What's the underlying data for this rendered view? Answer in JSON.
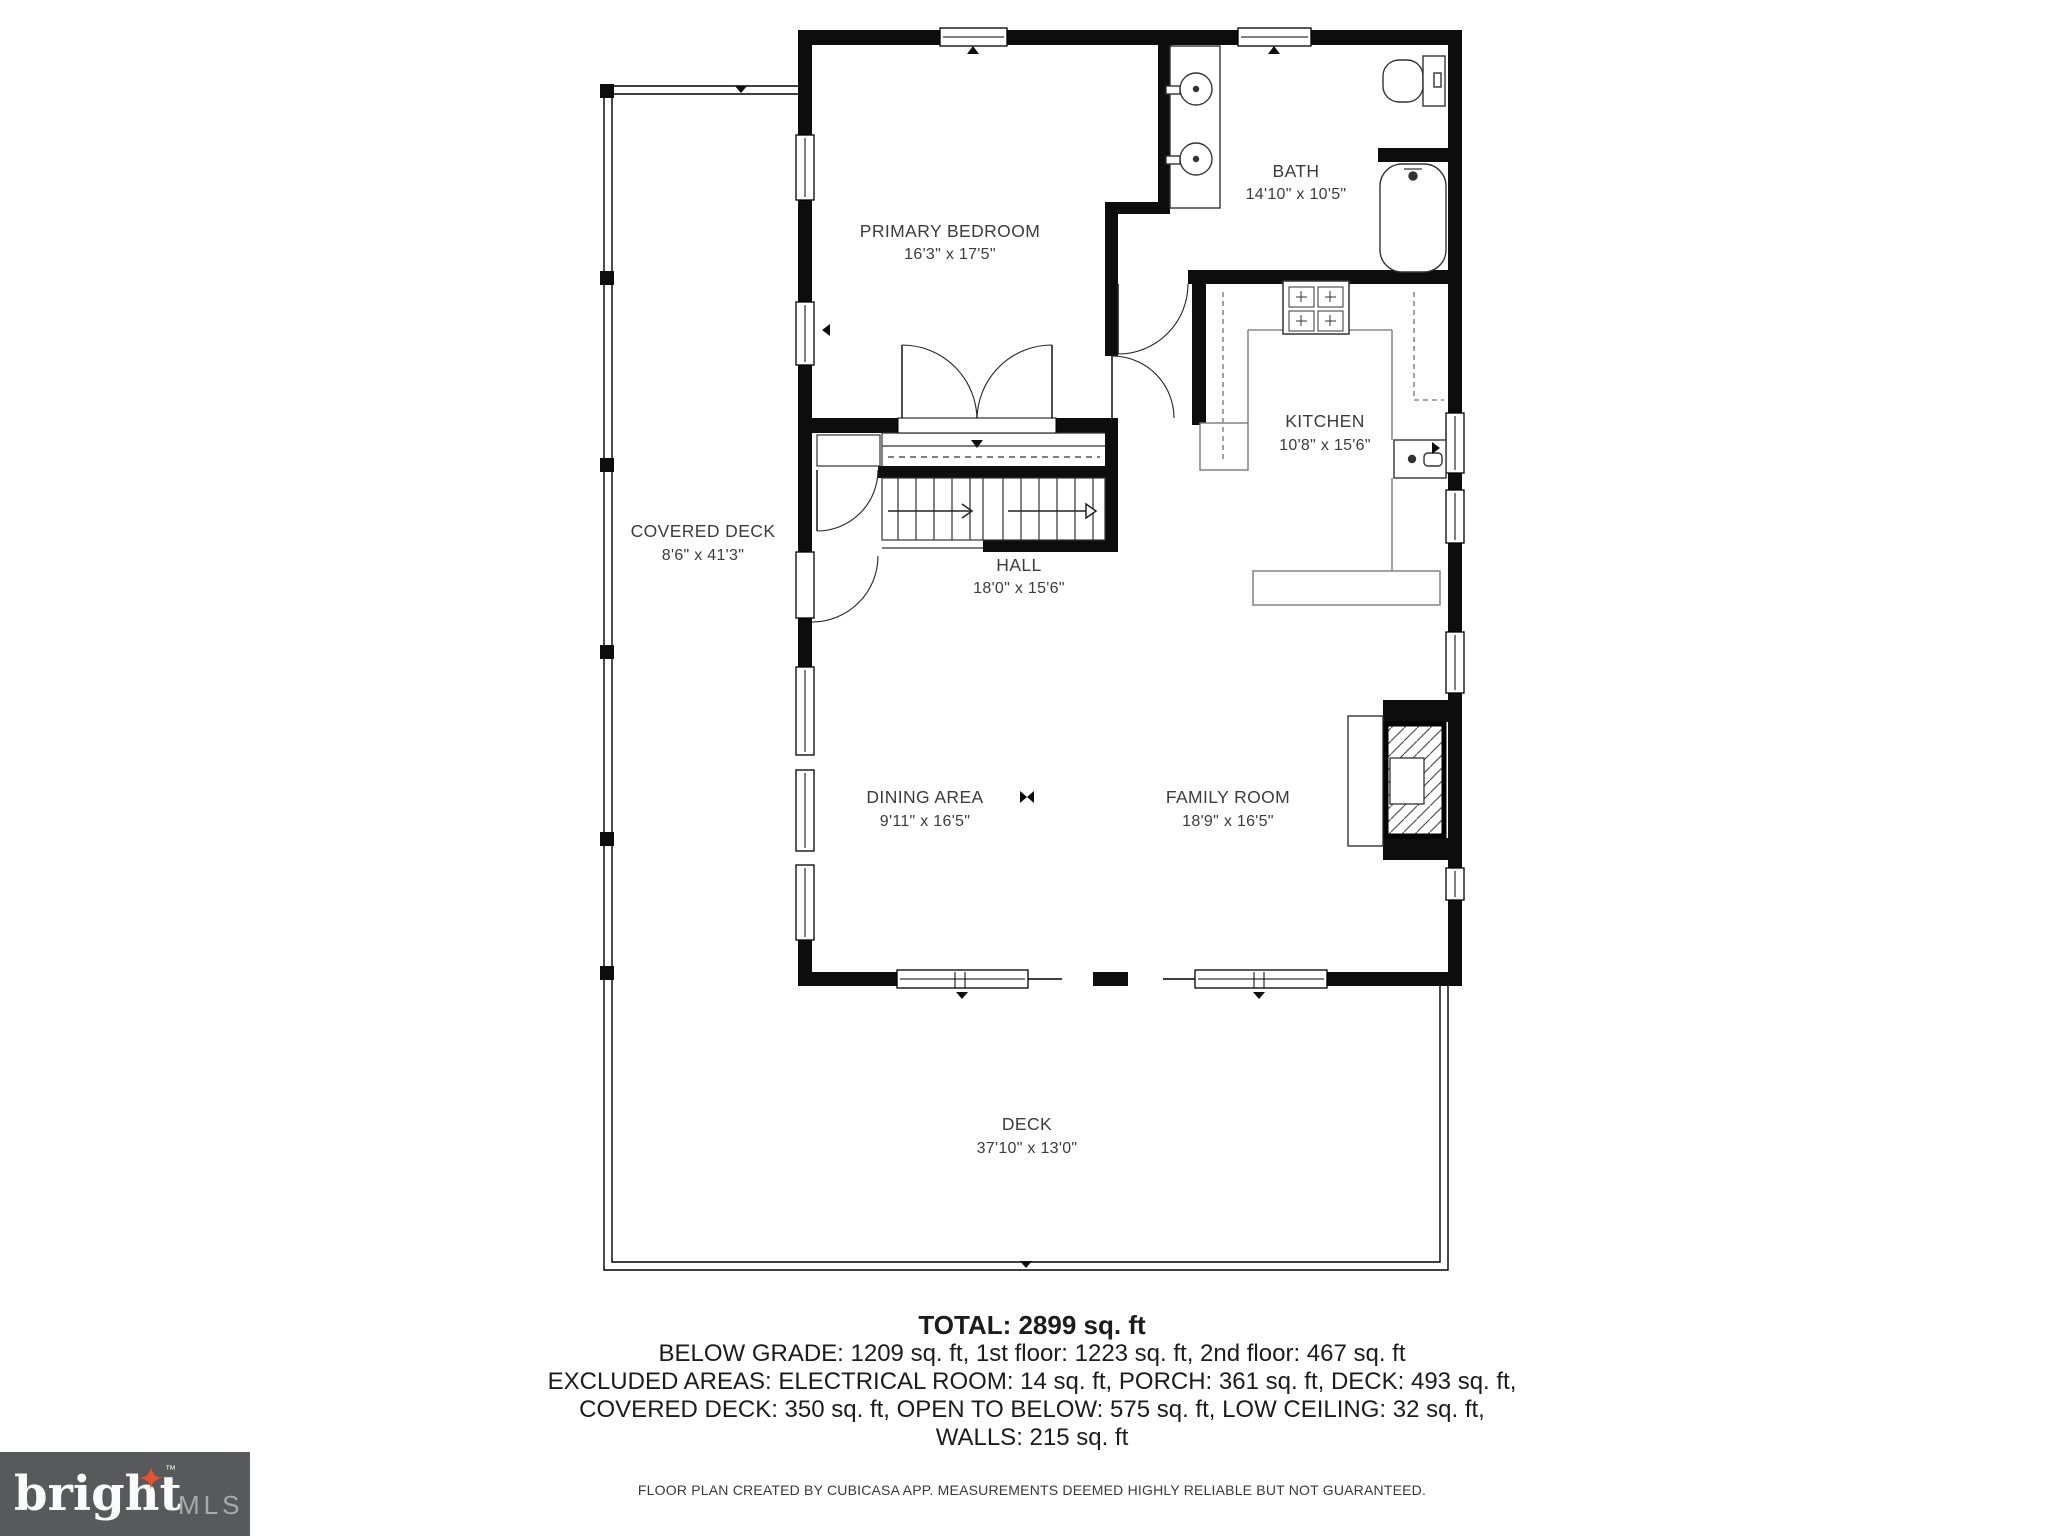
{
  "rooms": [
    {
      "name": "PRIMARY BEDROOM",
      "dims": "16'3\" x 17'5\""
    },
    {
      "name": "BATH",
      "dims": "14'10\" x 10'5\""
    },
    {
      "name": "KITCHEN",
      "dims": "10'8\" x 15'6\""
    },
    {
      "name": "HALL",
      "dims": "18'0\" x 15'6\""
    },
    {
      "name": "COVERED DECK",
      "dims": "8'6\" x 41'3\""
    },
    {
      "name": "DINING AREA",
      "dims": "9'11\" x 16'5\""
    },
    {
      "name": "FAMILY ROOM",
      "dims": "18'9\" x 16'5\""
    },
    {
      "name": "DECK",
      "dims": "37'10\" x 13'0\""
    }
  ],
  "summary": {
    "total": "TOTAL: 2899 sq. ft",
    "line1": "BELOW GRADE: 1209 sq. ft, 1st floor: 1223 sq. ft, 2nd floor: 467 sq. ft",
    "line2": "EXCLUDED AREAS: ELECTRICAL ROOM: 14 sq. ft, PORCH: 361 sq. ft, DECK: 493 sq. ft,",
    "line3": "COVERED DECK: 350 sq. ft, OPEN TO BELOW: 575 sq. ft, LOW CEILING: 32 sq. ft,",
    "line4": "WALLS: 215 sq. ft"
  },
  "disclaimer": "FLOOR PLAN CREATED BY CUBICASA APP. MEASUREMENTS DEEMED HIGHLY RELIABLE BUT NOT GUARANTEED.",
  "logo": {
    "brand": "bright",
    "tm": "™",
    "suffix": "MLS"
  },
  "colors": {
    "wall": "#0d0d0d",
    "label": "#3c3c3c",
    "logo_bg": "#58595b",
    "logo_star": "#e8502e",
    "logo_mls": "#a7a9ab"
  }
}
